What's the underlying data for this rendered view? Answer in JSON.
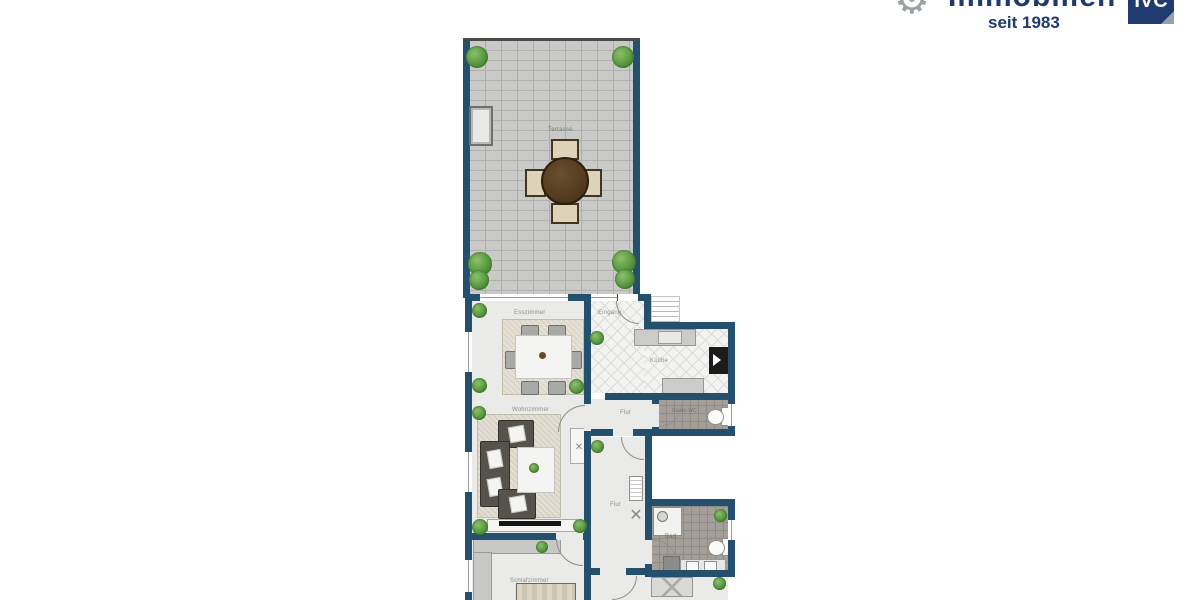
{
  "logo": {
    "gear_glyph": "⚙",
    "brand": "Immobilien",
    "badge": "IVC",
    "tagline": "seit 1983",
    "navy": "#1e3a6e"
  },
  "plan": {
    "labels": {
      "terrasse": "Terrasse",
      "esszimmer": "Esszimmer",
      "eingang": "Eingang",
      "kueche": "Küche",
      "flur_top": "Flur",
      "gaeste_wc": "Gäste-WC",
      "wohnzimmer": "Wohnzimmer",
      "flur": "Flur",
      "bad": "Bad",
      "schlafzimmer": "Schlafzimmer"
    },
    "colors": {
      "wall": "#24506e",
      "floor": "#eaeae8",
      "paving": "#c9c9c7",
      "tile_dark": "#a49e98",
      "rug": "#d8d2c3",
      "plant": "#4e8a38",
      "sofa": "#56524c",
      "terrace_table": "#5a4126"
    }
  },
  "icons": {
    "shelf_cross": "✕"
  }
}
